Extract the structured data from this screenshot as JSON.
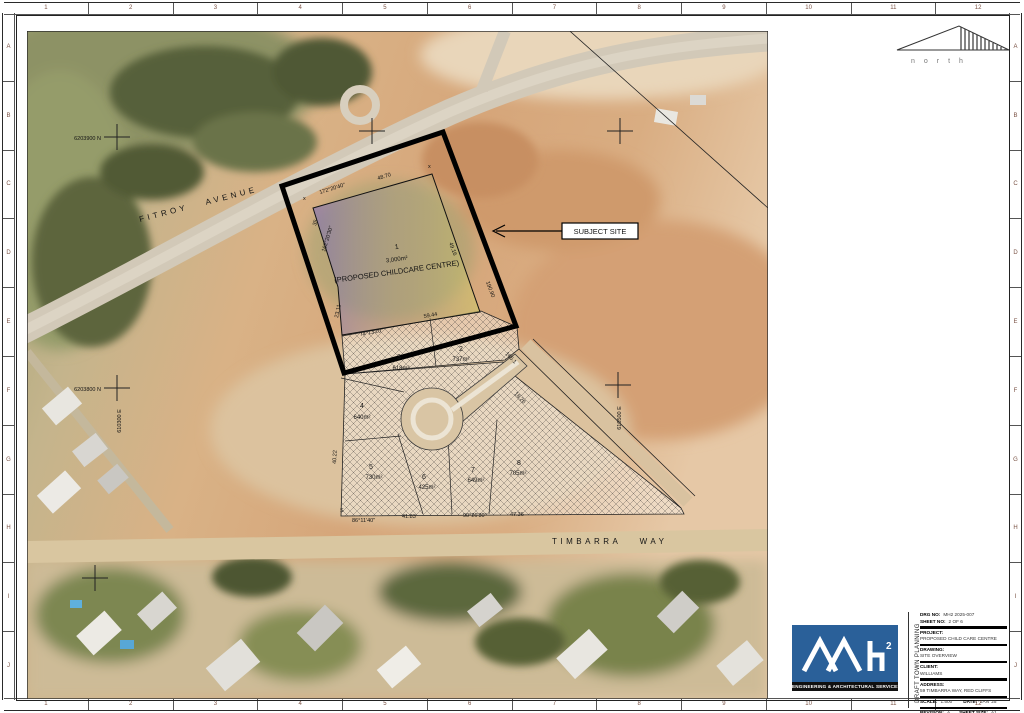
{
  "sheet": {
    "frame_cols": [
      "1",
      "2",
      "3",
      "4",
      "5",
      "6",
      "7",
      "8",
      "9",
      "10",
      "11",
      "12"
    ],
    "frame_rows": [
      "A",
      "B",
      "C",
      "D",
      "E",
      "F",
      "G",
      "H",
      "I",
      "J"
    ]
  },
  "north_label": "north",
  "map": {
    "street_fitroy": "FITROY AVENUE",
    "street_timbarra": "TIMBARRA WAY",
    "callout_label": "SUBJECT SITE",
    "coords": {
      "north_1": "6203900 N",
      "north_2": "6203800 N",
      "east_1": "610300 E",
      "east_2": "610500 E"
    },
    "lot1": {
      "num": "1",
      "area": "3,000m²",
      "use": "(PROPOSED CHILDCARE CENTRE)"
    },
    "lots": [
      {
        "num": "2",
        "area": "737m²"
      },
      {
        "num": "3",
        "area": "618m²"
      },
      {
        "num": "4",
        "area": "640m²"
      },
      {
        "num": "5",
        "area": "730m²"
      },
      {
        "num": "6",
        "area": "425m²"
      },
      {
        "num": "7",
        "area": "649m²"
      },
      {
        "num": "8",
        "area": "705m²"
      }
    ],
    "dims": {
      "top_bearing": "172°20'40\"",
      "top_len": "48.70",
      "left_bearing": "162°20'30\"",
      "left_len": "35",
      "left_low": "23.11",
      "bottom_bearing": "74°13'20\"",
      "bottom_len": "59.44",
      "right_len": "49.16",
      "right_low": "190.90",
      "road_len1": "165.1",
      "road_len2": "18.26",
      "west_len": "40.22",
      "s_mark": "S",
      "x_mark": "x",
      "bot_bearing1": "86°11'40\"",
      "bot_len1": "41.83",
      "bot_bearing2": "90°26'30\"",
      "bot_len2": "47.36"
    }
  },
  "titleblock": {
    "logo_sup": "2",
    "logo_tagline": "ENGINEERING & ARCHITECTURAL SERVICES",
    "stamp": "DRAFT TOWN PLANNING",
    "fields": {
      "drg_label": "DRG NO:",
      "drg": "MH2 2025-007",
      "sheet_label": "SHEET NO:",
      "sheet": "2 OF 6",
      "project_label": "PROJECT:",
      "project": "PROPOSED CHILD CARE CENTRE",
      "drawing_label": "DRAWING:",
      "drawing": "SITE OVERVIEW",
      "client_label": "CLIENT:",
      "client": "WILLIAMS",
      "address_label": "ADDRESS:",
      "address": "59 TIMBARRA WAY, RED CLIFFS",
      "scale_label": "SCALE:",
      "scale": "1:500",
      "date_label": "DATE:",
      "date": "JAN '25",
      "rev_label": "REVISION:",
      "rev": "A",
      "size_label": "SHEET SIZE:",
      "size": "A1"
    }
  }
}
